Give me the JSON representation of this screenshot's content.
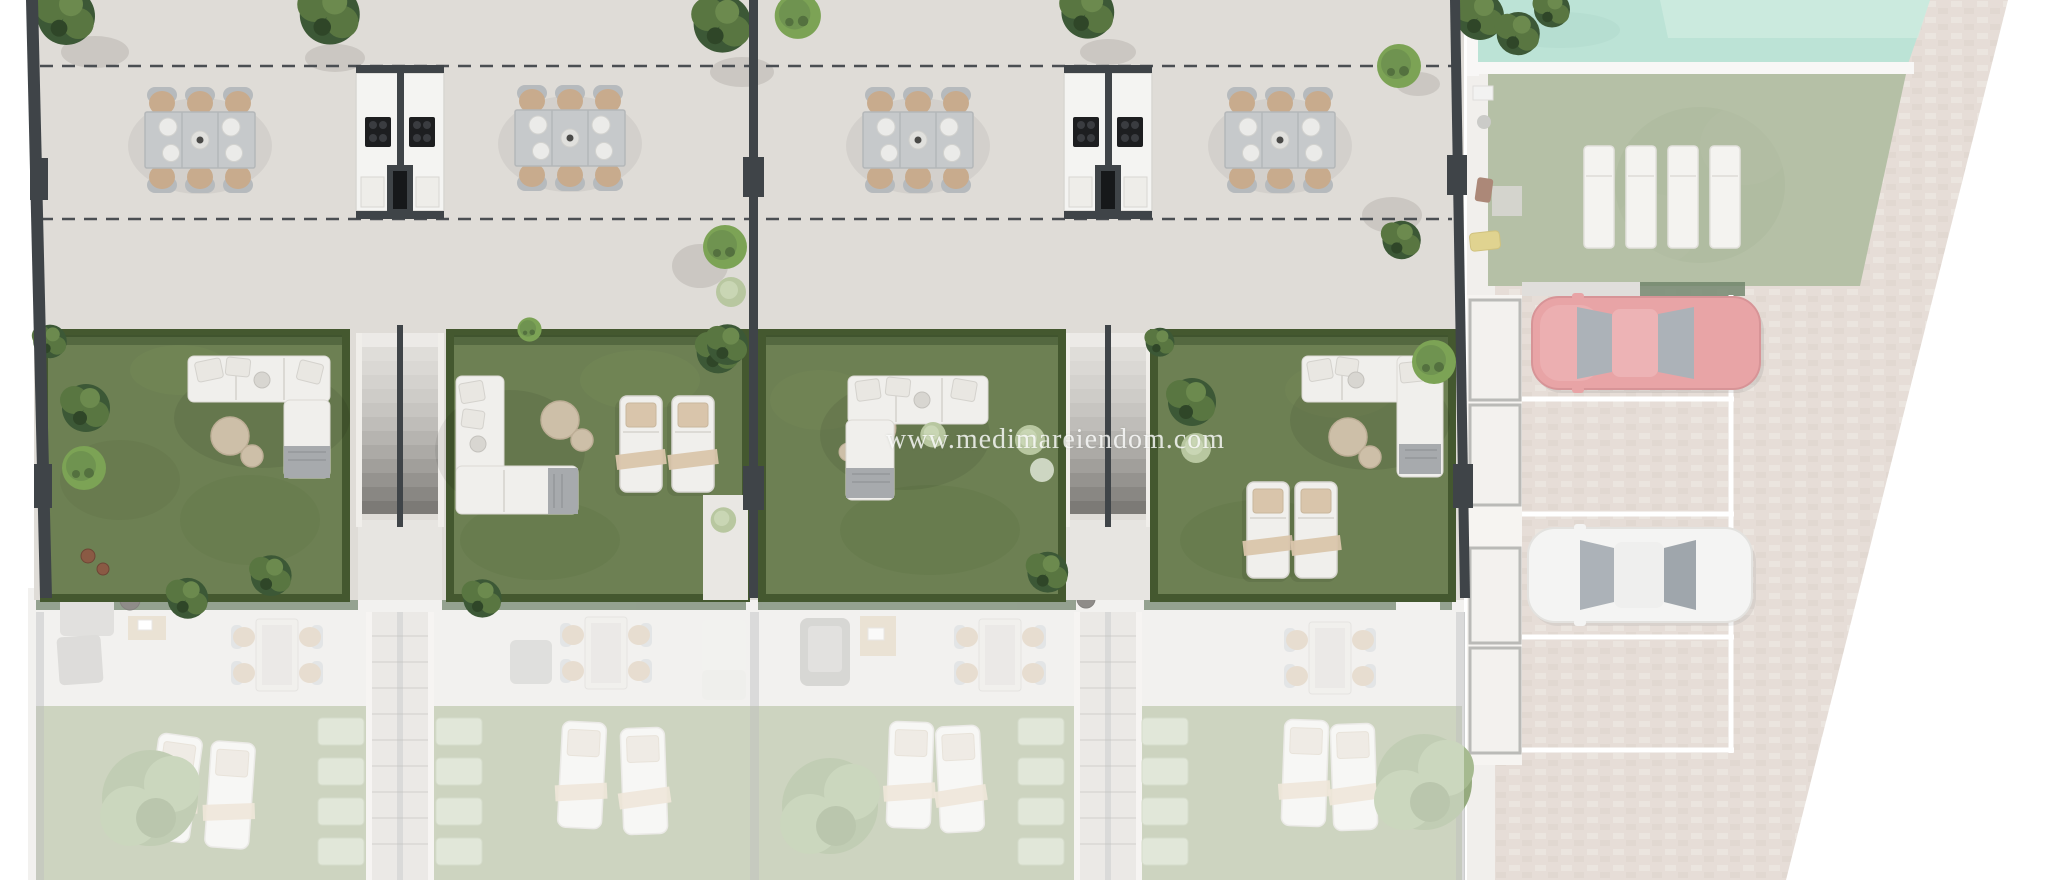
{
  "watermark": {
    "text": "www.medimareiendom.com"
  },
  "scene": {
    "type": "architectural site plan - top-down 3D render",
    "highlighted_area": "row of four townhouse units: upper terraces with outdoor dining and shared kitchen modules, private artificial-grass gardens with lounge furniture",
    "faded_areas": "lower-level terraces and lawns at bottom, communal pool, sunbathing lawn and parking court at right"
  },
  "units": [
    {
      "id": "unit-1",
      "upper_terrace": [
        "outdoor dining table with 6 chairs"
      ],
      "garden": [
        "L-shaped lounge sofa",
        "2 round poufs",
        "planters and shrubs",
        "2 rust pots"
      ]
    },
    {
      "id": "unit-2",
      "upper_terrace": [
        "outdoor dining table with 6 chairs"
      ],
      "garden": [
        "L-shaped lounge sofa",
        "2 round poufs",
        "2 sun loungers",
        "palm"
      ]
    },
    {
      "id": "unit-3",
      "upper_terrace": [
        "outdoor dining table with 6 chairs"
      ],
      "garden": [
        "L-shaped lounge sofa",
        "2 round poufs",
        "shrubs"
      ]
    },
    {
      "id": "unit-4",
      "upper_terrace": [
        "outdoor dining table with 6 chairs"
      ],
      "garden": [
        "L-shaped lounge sofa",
        "2 round poufs",
        "2 sun loungers",
        "shrubs"
      ]
    }
  ],
  "shared_elements": {
    "outdoor_kitchen_modules": 2,
    "grills_per_module": 2,
    "staircases_between_units": 2,
    "setback_dashed_lines": 2
  },
  "lower_level": {
    "per_unit_items": [
      "dining set with 4 chairs",
      "lounge seating",
      "2 sun loungers",
      "palm trees",
      "hedge strip"
    ],
    "ghost_staircases": 2,
    "shrub_rows_beside_stairs": 4
  },
  "amenities": {
    "pool": {
      "position": "top-right"
    },
    "pool_lawn_sun_loungers": 4,
    "parking": {
      "marked_bays": 4,
      "cars": [
        {
          "name": "red-car",
          "color": "#e18588"
        },
        {
          "name": "white-car",
          "color": "#f1f1ef"
        }
      ]
    }
  },
  "colors": {
    "grass": "#6d8053",
    "hedge": "#44582f",
    "grassFaded": "#aab593",
    "tile": "#dfdcd7",
    "wall": "#3f4448",
    "poolWater": "#a5d9c8",
    "poolWaterLight": "#c2e7d7",
    "poolLawn": "#9cab87",
    "cobble": "#ddd2ca",
    "cobbleLight": "#e7ded7",
    "carRed": "#e18588",
    "carSilver": "#f1f1ef",
    "glass": "#8f989f",
    "pouf": "#cdbfa8",
    "towel": "#d9c5ab",
    "seatTan": "#c8ab8d",
    "chairGray": "#b6babd",
    "tableTop": "#c6c9cb",
    "sofa": "#f0efec",
    "blanket": "#a7aaad",
    "palmDark": "#3c5836",
    "treeMid": "#597641",
    "treeRound": "#7ca355",
    "sage": "#b8c7a0",
    "dash": "#4a4e52",
    "terraceLower": "#e9e7e3",
    "whiteSurf": "#f4f3f1"
  }
}
